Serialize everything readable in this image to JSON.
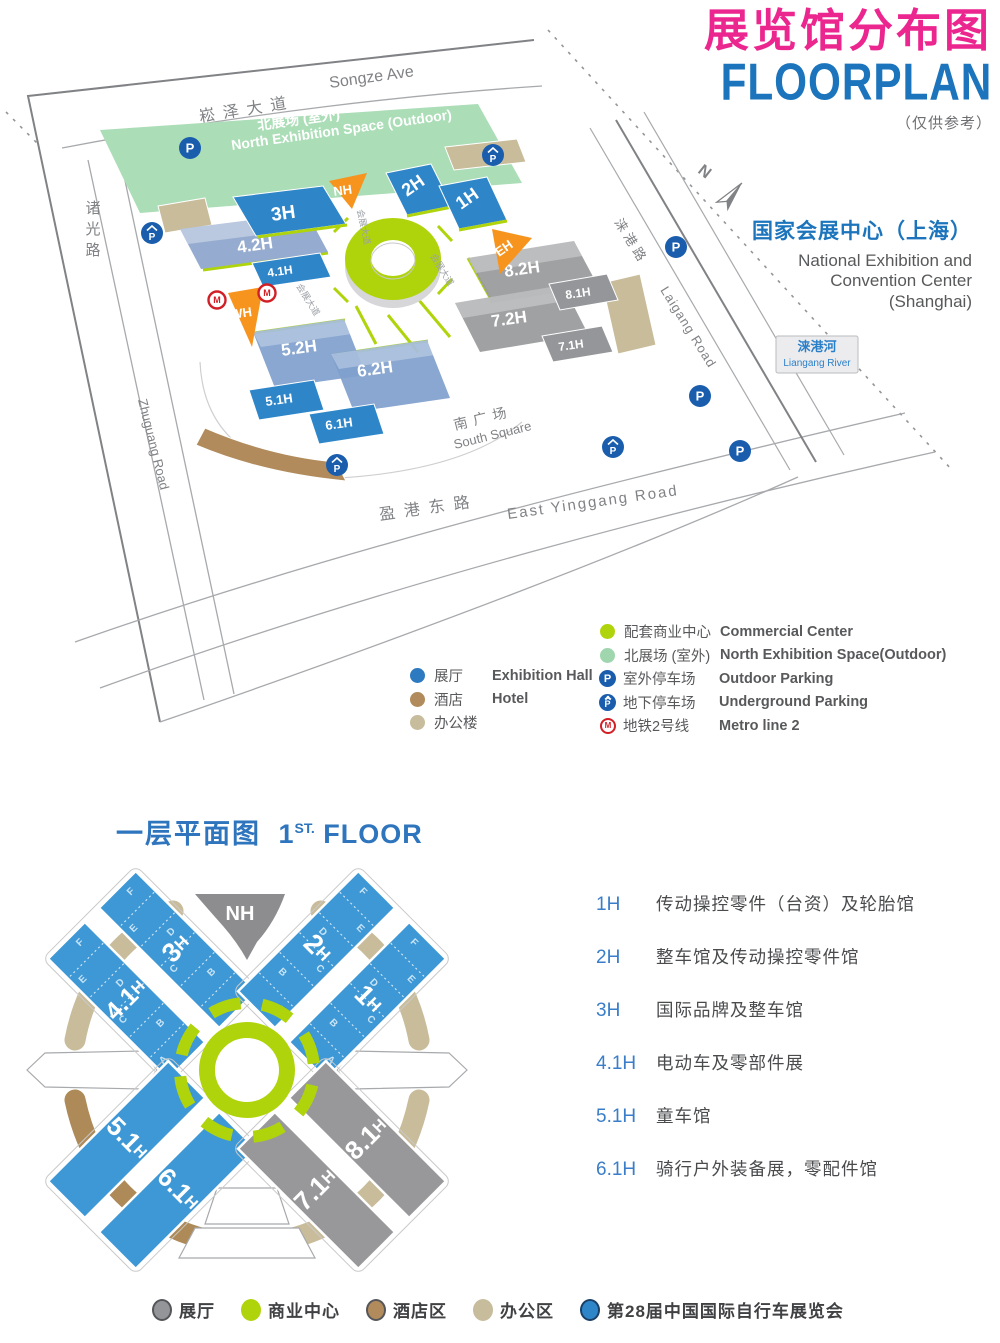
{
  "palette": {
    "title_pink": "#EC268F",
    "title_blue": "#1C75BC",
    "hall_blue_map": "#2E86C9",
    "hall_blue_floor": "#3E98D5",
    "hall_blue_upper": "#8FA6CD",
    "hall_gray": "#9B9C9E",
    "orange": "#F7941E",
    "ring_green": "#AFD40B",
    "north_green": "#ABDDB7",
    "hotel_brown": "#B18B5B",
    "office_tan": "#C9BC9B",
    "parking_blue": "#1A5DAD",
    "metro_red": "#D21F26",
    "text_gray": "#58595B",
    "road_gray": "#A7A9AC"
  },
  "header": {
    "title_zh": "展览馆分布图",
    "title_en": "FLOORPLAN",
    "note": "（仅供参考）"
  },
  "venue": {
    "name_zh": "国家会展中心（上海）",
    "en1": "National Exhibition and",
    "en2": "Convention Center",
    "en3": "(Shanghai)"
  },
  "map": {
    "compass": "N",
    "parking_letter": "P",
    "metro_letter": "M",
    "roads": {
      "songze_zh": "崧泽大道",
      "songze_en": "Songze Ave",
      "zhuguang_zh": "诸光路",
      "zhuguang_en": "Zhuguang Road",
      "yinggang_zh": "盈港东路",
      "yinggang_en": "East Yinggang Road",
      "laigang_zh": "涞港路",
      "laigang_en": "Laigang Road",
      "expo_ave_zh": "会展大道",
      "south_square_zh": "南广场",
      "south_square_en": "South Square"
    },
    "river": {
      "zh": "涞港河",
      "en": "Liangang River"
    },
    "north_space": {
      "zh": "北展场 (室外)",
      "en": "North Exhibition Space (Outdoor)"
    },
    "halls": {
      "h1": "1H",
      "h2": "2H",
      "h3": "3H",
      "h41": "4.1H",
      "h42": "4.2H",
      "h51": "5.1H",
      "h52": "5.2H",
      "h61": "6.1H",
      "h62": "6.2H",
      "h71": "7.1H",
      "h72": "7.2H",
      "h81": "8.1H",
      "h82": "8.2H",
      "nh": "NH",
      "eh": "EH",
      "wh": "WH"
    }
  },
  "legend_site": {
    "left": [
      {
        "zh": "展厅",
        "en": "Exhibition Hall"
      },
      {
        "zh": "酒店",
        "en": "Hotel"
      },
      {
        "zh": "办公楼",
        "en": ""
      }
    ],
    "right": [
      {
        "zh": "配套商业中心",
        "en": "Commercial Center"
      },
      {
        "zh": "北展场 (室外)",
        "en": "North Exhibition Space(Outdoor)"
      },
      {
        "zh": "室外停车场",
        "en": "Outdoor Parking"
      },
      {
        "zh": "地下停车场",
        "en": "Underground Parking"
      },
      {
        "zh": "地铁2号线",
        "en": "Metro line 2"
      }
    ]
  },
  "floor1": {
    "heading_zh": "一层平面图",
    "heading_num": "1",
    "heading_sup": "ST.",
    "heading_word": "FLOOR",
    "letters": [
      "A",
      "B",
      "C",
      "D",
      "E",
      "F"
    ],
    "halls": {
      "nh": "NH",
      "h1": {
        "num": "1",
        "suf": "H"
      },
      "h2": {
        "num": "2",
        "suf": "H"
      },
      "h3": {
        "num": "3",
        "suf": "H"
      },
      "h41": {
        "num": "4.1",
        "suf": "H"
      },
      "h51": {
        "num": "5.1",
        "suf": "H"
      },
      "h61": {
        "num": "6.1",
        "suf": "H"
      },
      "h71": {
        "num": "7.1",
        "suf": "H"
      },
      "h81": {
        "num": "8.1",
        "suf": "H"
      }
    },
    "list": [
      {
        "code": "1H",
        "desc": "传动操控零件（台资）及轮胎馆"
      },
      {
        "code": "2H",
        "desc": "整车馆及传动操控零件馆"
      },
      {
        "code": "3H",
        "desc": "国际品牌及整车馆"
      },
      {
        "code": "4.1H",
        "desc": "电动车及零部件展"
      },
      {
        "code": "5.1H",
        "desc": "童车馆"
      },
      {
        "code": "6.1H",
        "desc": "骑行户外装备展，零配件馆"
      }
    ],
    "legend": [
      {
        "zh": "展厅"
      },
      {
        "zh": "商业中心"
      },
      {
        "zh": "酒店区"
      },
      {
        "zh": "办公区"
      },
      {
        "zh": "第28届中国国际自行车展览会"
      }
    ]
  }
}
